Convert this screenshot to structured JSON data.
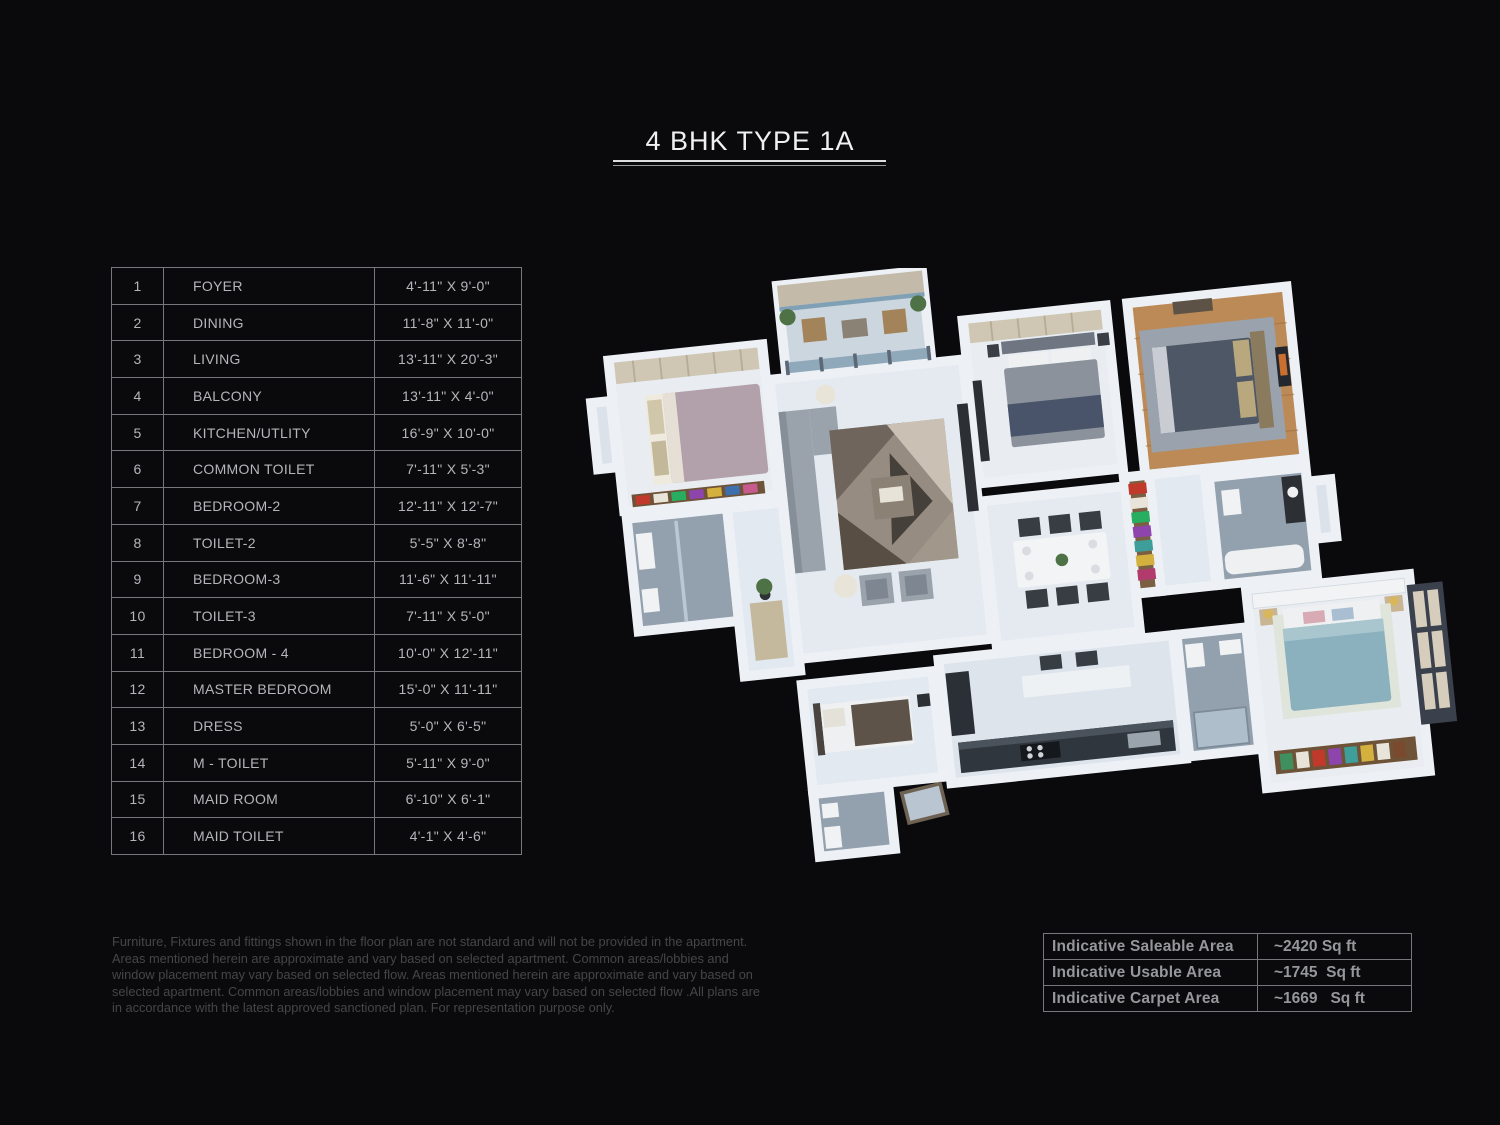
{
  "title": "4 BHK TYPE 1A",
  "rooms_table": {
    "rows": [
      {
        "no": "1",
        "name": "FOYER",
        "dims": "4'-11\" X 9'-0\""
      },
      {
        "no": "2",
        "name": "DINING",
        "dims": "11'-8\" X 11'-0\""
      },
      {
        "no": "3",
        "name": "LIVING",
        "dims": "13'-11\" X 20'-3\""
      },
      {
        "no": "4",
        "name": "BALCONY",
        "dims": "13'-11\" X 4'-0\""
      },
      {
        "no": "5",
        "name": "KITCHEN/UTLITY",
        "dims": "16'-9\" X 10'-0\""
      },
      {
        "no": "6",
        "name": "COMMON TOILET",
        "dims": "7'-11\" X 5'-3\""
      },
      {
        "no": "7",
        "name": "BEDROOM-2",
        "dims": "12'-11\" X 12'-7\""
      },
      {
        "no": "8",
        "name": "TOILET-2",
        "dims": "5'-5\" X 8'-8\""
      },
      {
        "no": "9",
        "name": "BEDROOM-3",
        "dims": "11'-6\" X 11'-11\""
      },
      {
        "no": "10",
        "name": "TOILET-3",
        "dims": "7'-11\" X 5'-0\""
      },
      {
        "no": "11",
        "name": "BEDROOM - 4",
        "dims": "10'-0\" X 12'-11\""
      },
      {
        "no": "12",
        "name": "MASTER BEDROOM",
        "dims": "15'-0\" X 11'-11\""
      },
      {
        "no": "13",
        "name": "DRESS",
        "dims": "5'-0\" X 6'-5\""
      },
      {
        "no": "14",
        "name": "M - TOILET",
        "dims": "5'-11\" X 9'-0\""
      },
      {
        "no": "15",
        "name": "MAID ROOM",
        "dims": "6'-10\" X 6'-1\""
      },
      {
        "no": "16",
        "name": "MAID TOILET",
        "dims": "4'-1\" X 4'-6\""
      }
    ]
  },
  "area_table": {
    "rows": [
      {
        "label": "Indicative Saleable Area",
        "value": "~2420 Sq ft"
      },
      {
        "label": "Indicative Usable Area",
        "value": "~1745  Sq ft"
      },
      {
        "label": "Indicative Carpet Area",
        "value": "~1669   Sq ft"
      }
    ]
  },
  "disclaimer": "Furniture, Fixtures and fittings shown in the floor plan are not standard and will not be provided in the apartment. Areas mentioned herein are approximate and vary based on selected apartment. Common areas/lobbies and window placement may vary based on selected flow. Areas mentioned herein are approximate and vary based on selected apartment. Common areas/lobbies and window placement may vary based on selected flow .All plans are in accordance with the latest approved sanctioned plan. For representation purpose only.",
  "colors": {
    "background": "#0a0a0c",
    "title_text": "#eef0f2",
    "table_text": "#b5b6b9",
    "table_border": "#77787b",
    "disclaimer_text": "#464648",
    "area_text": "#96979a",
    "plan_wall": "#edf1f6",
    "plan_floor": "#e4eaf0",
    "plan_tile": "#93a0ae",
    "plan_wood": "#bc8a57",
    "bed_teal": "#8ab1bd",
    "bed_mauve": "#b2a0ab"
  }
}
